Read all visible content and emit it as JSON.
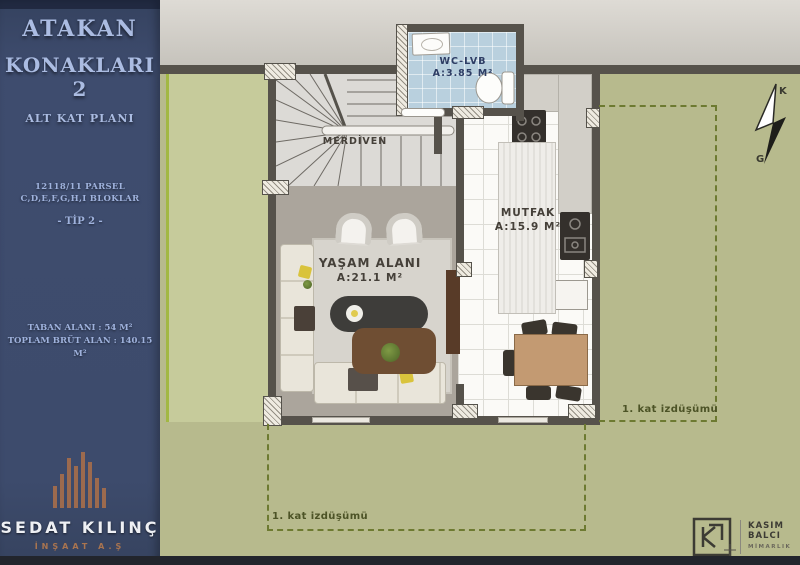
{
  "sidebar": {
    "title1": "ATAKAN",
    "title2": "KONAKLARI 2",
    "subtitle": "ALT KAT PLANI",
    "parcel1": "12118/11 PARSEL",
    "parcel2": "C,D,E,F,G,H,I BLOKLAR",
    "tip": "- TİP 2 -",
    "area1": "TABAN ALANI : 54 M²",
    "area2": "TOPLAM BRÜT ALAN : 140.15 M²",
    "brand": {
      "name": "SEDAT KILINÇ",
      "sub": "İNŞAAT A.Ş"
    }
  },
  "plan": {
    "wc": {
      "name": "WC-LVB",
      "area": "A:3.85 M²"
    },
    "stairs": {
      "name": "MERDİVEN"
    },
    "kitchen": {
      "name": "MUTFAK",
      "area": "A:15.9 M²"
    },
    "living": {
      "name": "YAŞAM ALANI",
      "area": "A:21.1 M²"
    },
    "projection_right": "1. kat izdüşümü",
    "projection_bottom": "1. kat izdüşümü",
    "compass": {
      "north": "K",
      "south": "G"
    }
  },
  "architect": {
    "line1": "KASIM",
    "line2": "BALCI",
    "line3": "MİMARLIK"
  },
  "colors": {
    "sidebar_navy": "#3d4b6c",
    "sidebar_text": "#a9bade",
    "site_green": "#b7ba8d",
    "garden_patch": "#c6cb9b",
    "wall_gray": "#56524b",
    "wc_floor_blue": "#b9d0de",
    "projection_dash": "#6d7a31",
    "brand_copper": "#a9744f"
  }
}
